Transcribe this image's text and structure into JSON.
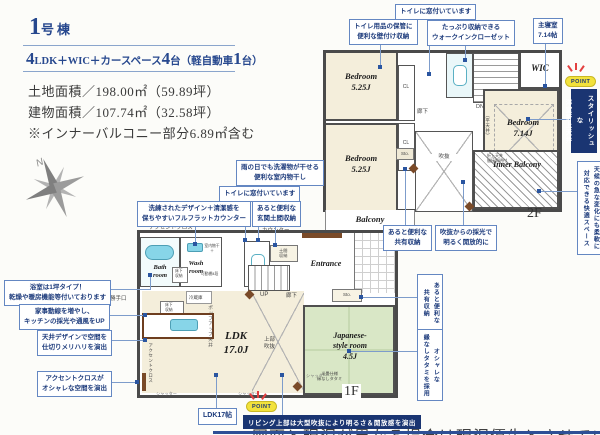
{
  "header": {
    "building_no_num": "1",
    "building_no_label": "号棟",
    "spec_n1": "4",
    "spec_t1": "LDK＋WIC＋カースペース",
    "spec_n2": "4",
    "spec_t2": "台（軽自動車",
    "spec_n3": "1",
    "spec_t3": "台）",
    "land_area": "土地面積／198.00㎡（59.89坪）",
    "building_area": "建物面積／107.74㎡（32.58坪）",
    "area_note": "※インナーバルコニー部分6.89㎡含む"
  },
  "compass": {
    "north_label": "N"
  },
  "floor2": {
    "floor_label": "2F",
    "rooms": {
      "bedroom_a": "Bedroom\n5.25J",
      "bedroom_b": "Bedroom\n5.25J",
      "bedroom_main": "Bedroom\n7.14J",
      "wic": "WIC",
      "inner_balcony": "Inner Balcony",
      "balcony": "Balcony"
    },
    "labels": {
      "counter": "カウンター",
      "cl_a": "CL",
      "cl_b": "CL",
      "sto": "Sto.",
      "dn": "DN",
      "hallway": "廊下",
      "void_label": "吹抜",
      "flat_ceiling": "（平天井）",
      "coffered_note": "折上天井\n間接照明付"
    },
    "callouts": {
      "toilet_window": "トイレに窓付いています",
      "wall_storage": "トイレ用品の保管に\n便利な壁付け収納",
      "wic_note": "たっぷり収納できる\nウォークインクローゼット",
      "main_bedroom": "主寝室\n7.14帖",
      "shared_storage": "あると便利な\n共有収納",
      "void_light": "吹抜からの採光で\n明るく開放的に",
      "inner_balcony_note": "天候の急な変化にも柔軟に\n対応できる快適スペース"
    },
    "point": {
      "label": "POINT",
      "banner": "スタイリッシュな\n洋室折上天井"
    }
  },
  "floor1": {
    "floor_label": "1F",
    "rooms": {
      "ldk": "LDK\n17.0J",
      "japanese": "Japanese-\nstyle room\n4.5J",
      "bath": "Bath\nroom",
      "wash": "Wash\nroom",
      "entrance": "Entrance"
    },
    "labels": {
      "accent_cloth": "アクセントクロス",
      "open_sanitary": "オープンサニタリー",
      "counter": "カウンター",
      "doma_storage": "土間\n収納",
      "up": "UP",
      "hallway": "廊下",
      "sto": "Sto.",
      "kitchen_door": "勝手口",
      "underfloor_wash": "床下\n収納",
      "underfloor_kitchen": "床下\n収納",
      "fridge": "冷蔵庫",
      "popup_ceiling": "ポップアップ天井",
      "upper_void": "上部\n吹抜",
      "accent_cloth_v": "アクセントクロス",
      "indoor_drying": "室内物干＋",
      "movable_shelf": "可動棚4段",
      "tatami_note": "半畳仕様\n縁なしタタミ",
      "shutter": "シャッター"
    },
    "callouts": {
      "indoor_drying": "雨の日でも洗濯物が干せる\n便利な室内物干し",
      "toilet_window": "トイレに窓付いています",
      "flat_counter": "洗練されたデザイン＋清潔感を\n保ちやすいフルフラットカウンター",
      "entrance_storage": "あると便利な\n玄関土間収納",
      "bath_note": "浴室は1坪タイプ！\n乾燥や暖房機能等付いております",
      "kitchen_flow": "家事動線を増やし、\nキッチンの採光や通風をUP",
      "ceiling_design": "天井デザインで空間を\n仕切りメリハリを演出",
      "accent_cloth": "アクセントクロスが\nオシャレな空間を演出",
      "ldk_size": "LDK17帖",
      "shared_storage": "あると便利な\n共有収納",
      "tatami": "オシャレな\n縁なしタタミを採用"
    },
    "point": {
      "label": "POINT",
      "banner": "リビング上部は大型吹抜により明るさ＆開放感を演出"
    }
  },
  "footer": {
    "disclaimer": "図面と現況が異なる場合は現況優先とさせていただきます"
  },
  "colors": {
    "accent_navy": "#1a3572",
    "callout_blue": "#6487c2",
    "room_cream": "#f4eedb",
    "tatami_green": "#d9e7c6",
    "fixture_cyan": "#87d5e8"
  }
}
